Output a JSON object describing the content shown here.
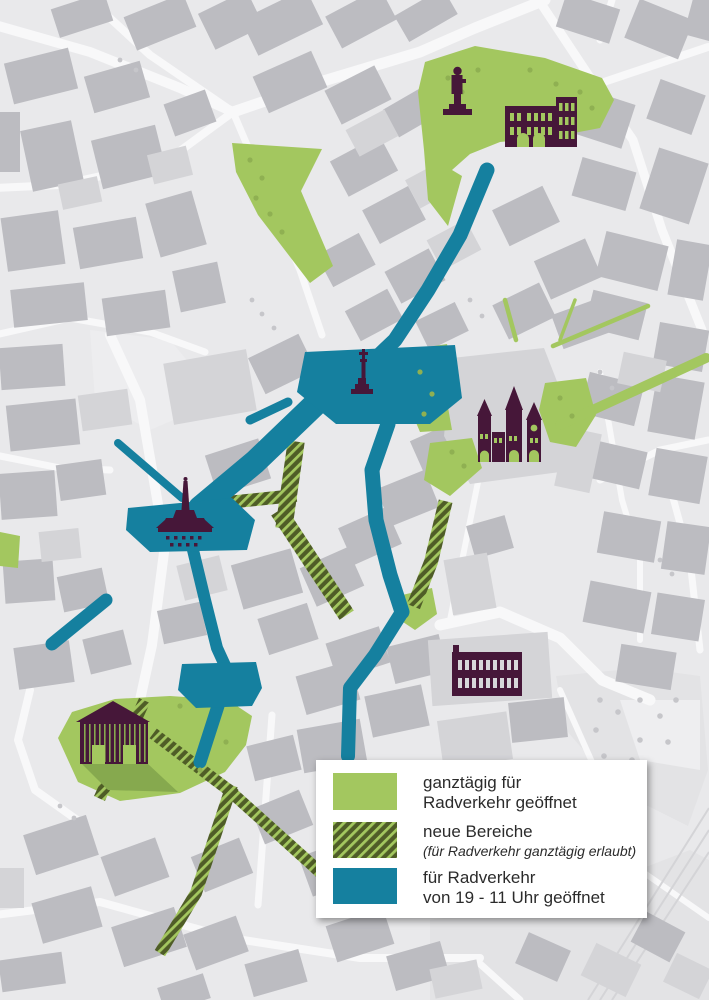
{
  "map": {
    "name": "innenstadt-radverkehr-zonen-karte",
    "city_features": "pedestrian zone bicycle access map"
  },
  "colors": {
    "open_green": "#a3c75f",
    "hatch_dark": "#4f5d27",
    "hatch_light": "#a3c75f",
    "timed_teal": "#15809f",
    "landmark_purple": "#461739",
    "window_light": "#d7d7da",
    "shadow_green": "#86a94e",
    "tree_green": "#8fb052",
    "map_background": "#e9e9eb",
    "street_white": "#f8f8f9",
    "building_gray": "#bcbcc1",
    "building_light": "#d4d4d7",
    "park_light": "#e3e3e5",
    "tree_gray": "#c6c6ca",
    "legend_text": "#2b2b2b"
  },
  "legend": {
    "items": [
      {
        "id": "open-all-day",
        "swatch": "solid-green",
        "line1": "ganztägig für",
        "line2": "Radverkehr geöffnet"
      },
      {
        "id": "new-areas",
        "swatch": "hatched-green",
        "line1": "neue Bereiche",
        "line2": "(für Radverkehr ganztägig erlaubt)"
      },
      {
        "id": "timed-open",
        "swatch": "solid-teal",
        "line1": "für Radverkehr",
        "line2": "von 19 - 11 Uhr geöffnet"
      }
    ]
  },
  "landmarks": [
    {
      "name": "statue-icon"
    },
    {
      "name": "porta-nigra-icon"
    },
    {
      "name": "market-cross-icon"
    },
    {
      "name": "cathedral-icon"
    },
    {
      "name": "fountain-icon"
    },
    {
      "name": "basilica-icon"
    },
    {
      "name": "thermen-icon"
    }
  ]
}
